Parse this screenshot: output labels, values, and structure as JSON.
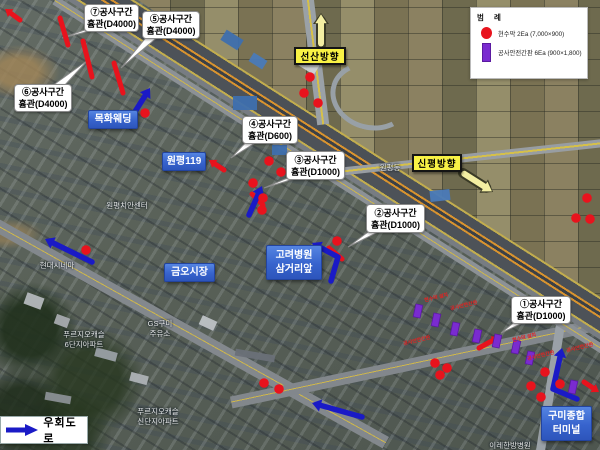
{
  "legend": {
    "title": "범 례",
    "items": [
      {
        "swatch": "dot",
        "color": "#e8131d",
        "label": "현수막 2Ea (7,000×900)"
      },
      {
        "swatch": "rect",
        "color": "#7a2bd0",
        "label": "공사안전간판 6Ea (900×1,800)"
      }
    ]
  },
  "construction_labels": [
    {
      "line1": "⑦공사구간",
      "line2": "흄관(D4000)",
      "x": 84,
      "y": 4,
      "w": 53,
      "h": 26,
      "tip": [
        62,
        38
      ]
    },
    {
      "line1": "⑤공사구간",
      "line2": "흄관(D4000)",
      "x": 142,
      "y": 11,
      "w": 56,
      "h": 26,
      "tip": [
        121,
        68
      ]
    },
    {
      "line1": "⑥공사구간",
      "line2": "흄관(D4000)",
      "x": 14,
      "y": 84,
      "w": 56,
      "h": 26,
      "tip": [
        88,
        60
      ]
    },
    {
      "line1": "④공사구간",
      "line2": "흄관(D600)",
      "x": 242,
      "y": 116,
      "w": 54,
      "h": 26,
      "tip": [
        231,
        158
      ]
    },
    {
      "line1": "③공사구간",
      "line2": "흄관(D1000)",
      "x": 286,
      "y": 151,
      "w": 57,
      "h": 27,
      "tip": [
        264,
        188
      ]
    },
    {
      "line1": "②공사구간",
      "line2": "흄관(D1000)",
      "x": 366,
      "y": 204,
      "w": 57,
      "h": 27,
      "tip": [
        348,
        247
      ]
    },
    {
      "line1": "①공사구간",
      "line2": "흄관(D1000)",
      "x": 511,
      "y": 296,
      "w": 58,
      "h": 26,
      "tip": [
        501,
        333
      ]
    }
  ],
  "direction_labels": [
    {
      "text": "선산방향",
      "x": 294,
      "y": 47,
      "w": 52,
      "h": 18,
      "arrow": [
        [
          321,
          45
        ],
        [
          321,
          13
        ]
      ]
    },
    {
      "text": "신평방향",
      "x": 412,
      "y": 154,
      "w": 50,
      "h": 18,
      "arrow": [
        [
          463,
          173
        ],
        [
          493,
          192
        ]
      ]
    }
  ],
  "place_labels": [
    {
      "lines": [
        "목화웨딩"
      ],
      "x": 88,
      "y": 110,
      "w": 48,
      "h": 17
    },
    {
      "lines": [
        "원평119"
      ],
      "x": 162,
      "y": 152,
      "w": 42,
      "h": 17
    },
    {
      "lines": [
        "금오시장"
      ],
      "x": 164,
      "y": 263,
      "w": 49,
      "h": 17
    },
    {
      "lines": [
        "고려병원",
        "삼거리앞"
      ],
      "x": 266,
      "y": 245,
      "w": 54,
      "h": 33
    },
    {
      "lines": [
        "구미종합",
        "터미널"
      ],
      "x": 541,
      "y": 406,
      "w": 49,
      "h": 33
    }
  ],
  "bypass": {
    "label": "우회도로"
  },
  "markers": {
    "red_dots": [
      [
        145,
        113
      ],
      [
        310,
        77
      ],
      [
        304,
        93
      ],
      [
        318,
        103
      ],
      [
        269,
        161
      ],
      [
        281,
        172
      ],
      [
        253,
        183
      ],
      [
        263,
        198
      ],
      [
        262,
        210
      ],
      [
        86,
        250
      ],
      [
        337,
        241
      ],
      [
        264,
        383
      ],
      [
        279,
        389
      ],
      [
        587,
        198
      ],
      [
        576,
        218
      ],
      [
        590,
        219
      ],
      [
        435,
        363
      ],
      [
        447,
        368
      ],
      [
        440,
        375
      ],
      [
        545,
        372
      ],
      [
        531,
        386
      ],
      [
        541,
        397
      ],
      [
        560,
        384
      ]
    ],
    "red_segments": [
      {
        "x1": 60,
        "y1": 18,
        "x2": 68,
        "y2": 45
      },
      {
        "x1": 83,
        "y1": 41,
        "x2": 92,
        "y2": 77
      },
      {
        "x1": 114,
        "y1": 63,
        "x2": 123,
        "y2": 93
      },
      {
        "x1": 252,
        "y1": 194,
        "x2": 263,
        "y2": 205
      },
      {
        "x1": 329,
        "y1": 248,
        "x2": 342,
        "y2": 259
      },
      {
        "x1": 20,
        "y1": 20,
        "x2": 5,
        "y2": 9,
        "arrow": true
      },
      {
        "x1": 224,
        "y1": 170,
        "x2": 209,
        "y2": 160,
        "arrow": true
      },
      {
        "x1": 479,
        "y1": 348,
        "x2": 499,
        "y2": 337,
        "arrow": true
      },
      {
        "x1": 584,
        "y1": 382,
        "x2": 599,
        "y2": 392,
        "arrow": true
      }
    ],
    "blue_arrows": [
      {
        "pts": [
          [
            131,
            118
          ],
          [
            150,
            88
          ]
        ]
      },
      {
        "pts": [
          [
            92,
            262
          ],
          [
            45,
            239
          ]
        ]
      },
      {
        "pts": [
          [
            249,
            215
          ],
          [
            262,
            186
          ]
        ]
      },
      {
        "pts": [
          [
            331,
            281
          ],
          [
            338,
            257
          ],
          [
            312,
            243
          ]
        ]
      },
      {
        "pts": [
          [
            362,
            417
          ],
          [
            312,
            403
          ]
        ]
      },
      {
        "pts": [
          [
            577,
            399
          ],
          [
            553,
            389
          ],
          [
            562,
            348
          ]
        ]
      }
    ],
    "purple_signs": [
      [
        418,
        311
      ],
      [
        436,
        320
      ],
      [
        455,
        329
      ],
      [
        477,
        336
      ],
      [
        497,
        341
      ],
      [
        516,
        347
      ],
      [
        530,
        358
      ],
      [
        573,
        387
      ]
    ],
    "red_notes": [
      {
        "text": "현수막 설치",
        "x": 424,
        "y": 294
      },
      {
        "text": "공사안전간판",
        "x": 450,
        "y": 302
      },
      {
        "text": "공사안전간판",
        "x": 403,
        "y": 337
      },
      {
        "text": "현수막 설치",
        "x": 512,
        "y": 334
      },
      {
        "text": "공사안전간판",
        "x": 527,
        "y": 352
      },
      {
        "text": "공사안전간판",
        "x": 566,
        "y": 344
      }
    ]
  },
  "base_map": {
    "labels": [
      {
        "text": "원평치안센터",
        "x": 127,
        "y": 200
      },
      {
        "text": "현대시네마",
        "x": 57,
        "y": 260
      },
      {
        "text": "원평동",
        "x": 390,
        "y": 162
      },
      {
        "text": "푸르지오캐슬",
        "x": 84,
        "y": 329
      },
      {
        "text": "6단지아파트",
        "x": 84,
        "y": 339
      },
      {
        "text": "GS구미",
        "x": 160,
        "y": 318
      },
      {
        "text": "주유소",
        "x": 160,
        "y": 328
      },
      {
        "text": "푸르지오캐슬",
        "x": 158,
        "y": 406
      },
      {
        "text": "신단지아파트",
        "x": 158,
        "y": 416
      },
      {
        "text": "이레한방병원",
        "x": 510,
        "y": 440
      }
    ]
  }
}
